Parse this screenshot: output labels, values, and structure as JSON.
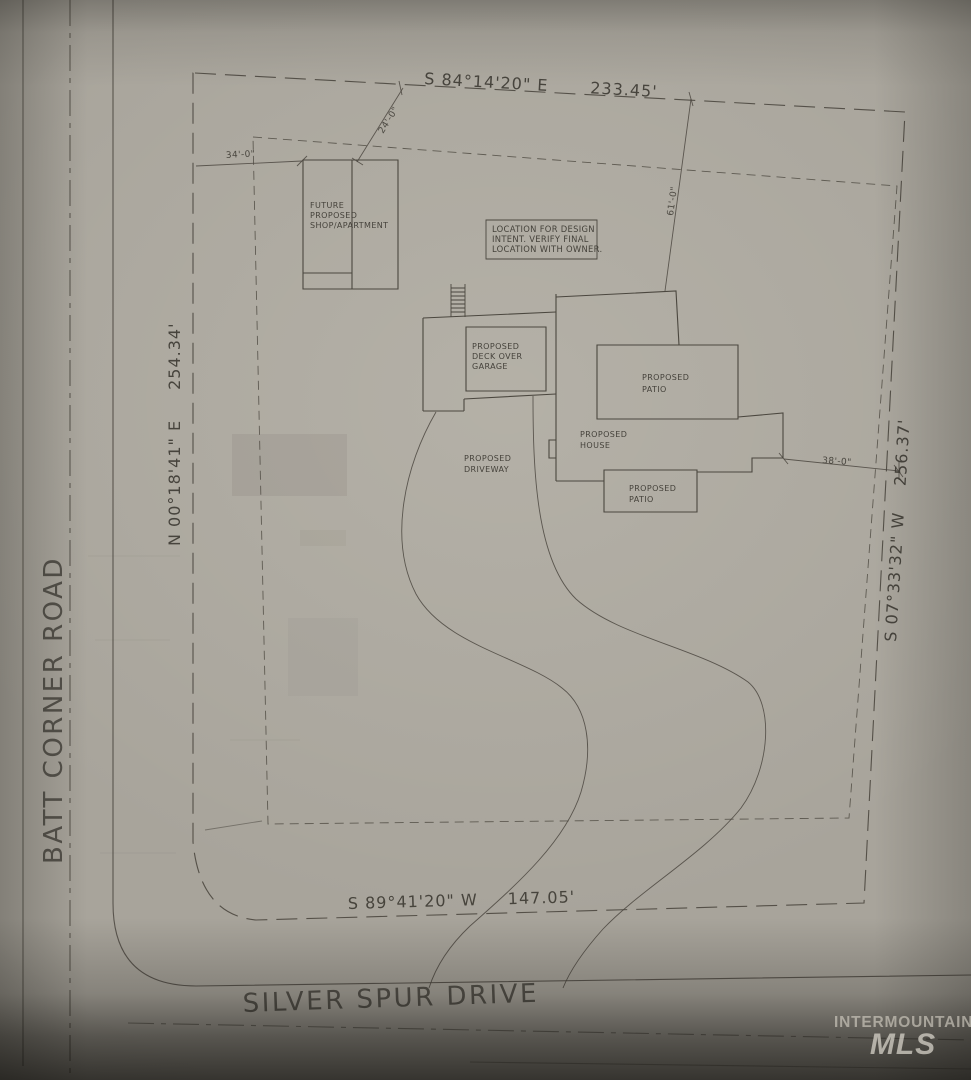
{
  "document": {
    "kind": "scanned residential site plan",
    "watermark": {
      "line1": "INTERMOUNTAIN",
      "line2": "MLS"
    }
  },
  "roads": {
    "batt_corner": {
      "name": "BATT CORNER ROAD"
    },
    "silver_spur": {
      "name": "SILVER SPUR DRIVE"
    }
  },
  "boundaries": {
    "north": {
      "bearing": "S 84°14'20\" E",
      "distance": "233.45'"
    },
    "west": {
      "bearing": "N 00°18'41\" E",
      "distance": "254.34'"
    },
    "east": {
      "bearing": "S 07°33'32\" W",
      "distance": "256.37'"
    },
    "south": {
      "bearing": "S 89°41'20\" W",
      "distance": "147.05'"
    }
  },
  "dimensions": {
    "d34": "34'-0\"",
    "d24": "24'-0\"",
    "d61": "61'-0\"",
    "d38": "38'-0\""
  },
  "note": {
    "lines": [
      "LOCATION FOR DESIGN",
      "INTENT.  VERIFY FINAL",
      "LOCATION WITH OWNER."
    ]
  },
  "buildings": {
    "shop": {
      "lines": [
        "FUTURE",
        "PROPOSED",
        "SHOP/APARTMENT"
      ]
    },
    "deck": {
      "lines": [
        "PROPOSED",
        "DECK OVER",
        "GARAGE"
      ]
    },
    "patio_upper": {
      "lines": [
        "PROPOSED",
        "PATIO"
      ]
    },
    "house": {
      "lines": [
        "PROPOSED",
        "HOUSE"
      ]
    },
    "patio_lower": {
      "lines": [
        "PROPOSED",
        "PATIO"
      ]
    },
    "driveway": {
      "lines": [
        "PROPOSED",
        "DRIVEWAY"
      ]
    }
  },
  "colors": {
    "paper": "#a8a49b",
    "ink": "#4b473f",
    "watermark_text": "#d6d2c7"
  }
}
